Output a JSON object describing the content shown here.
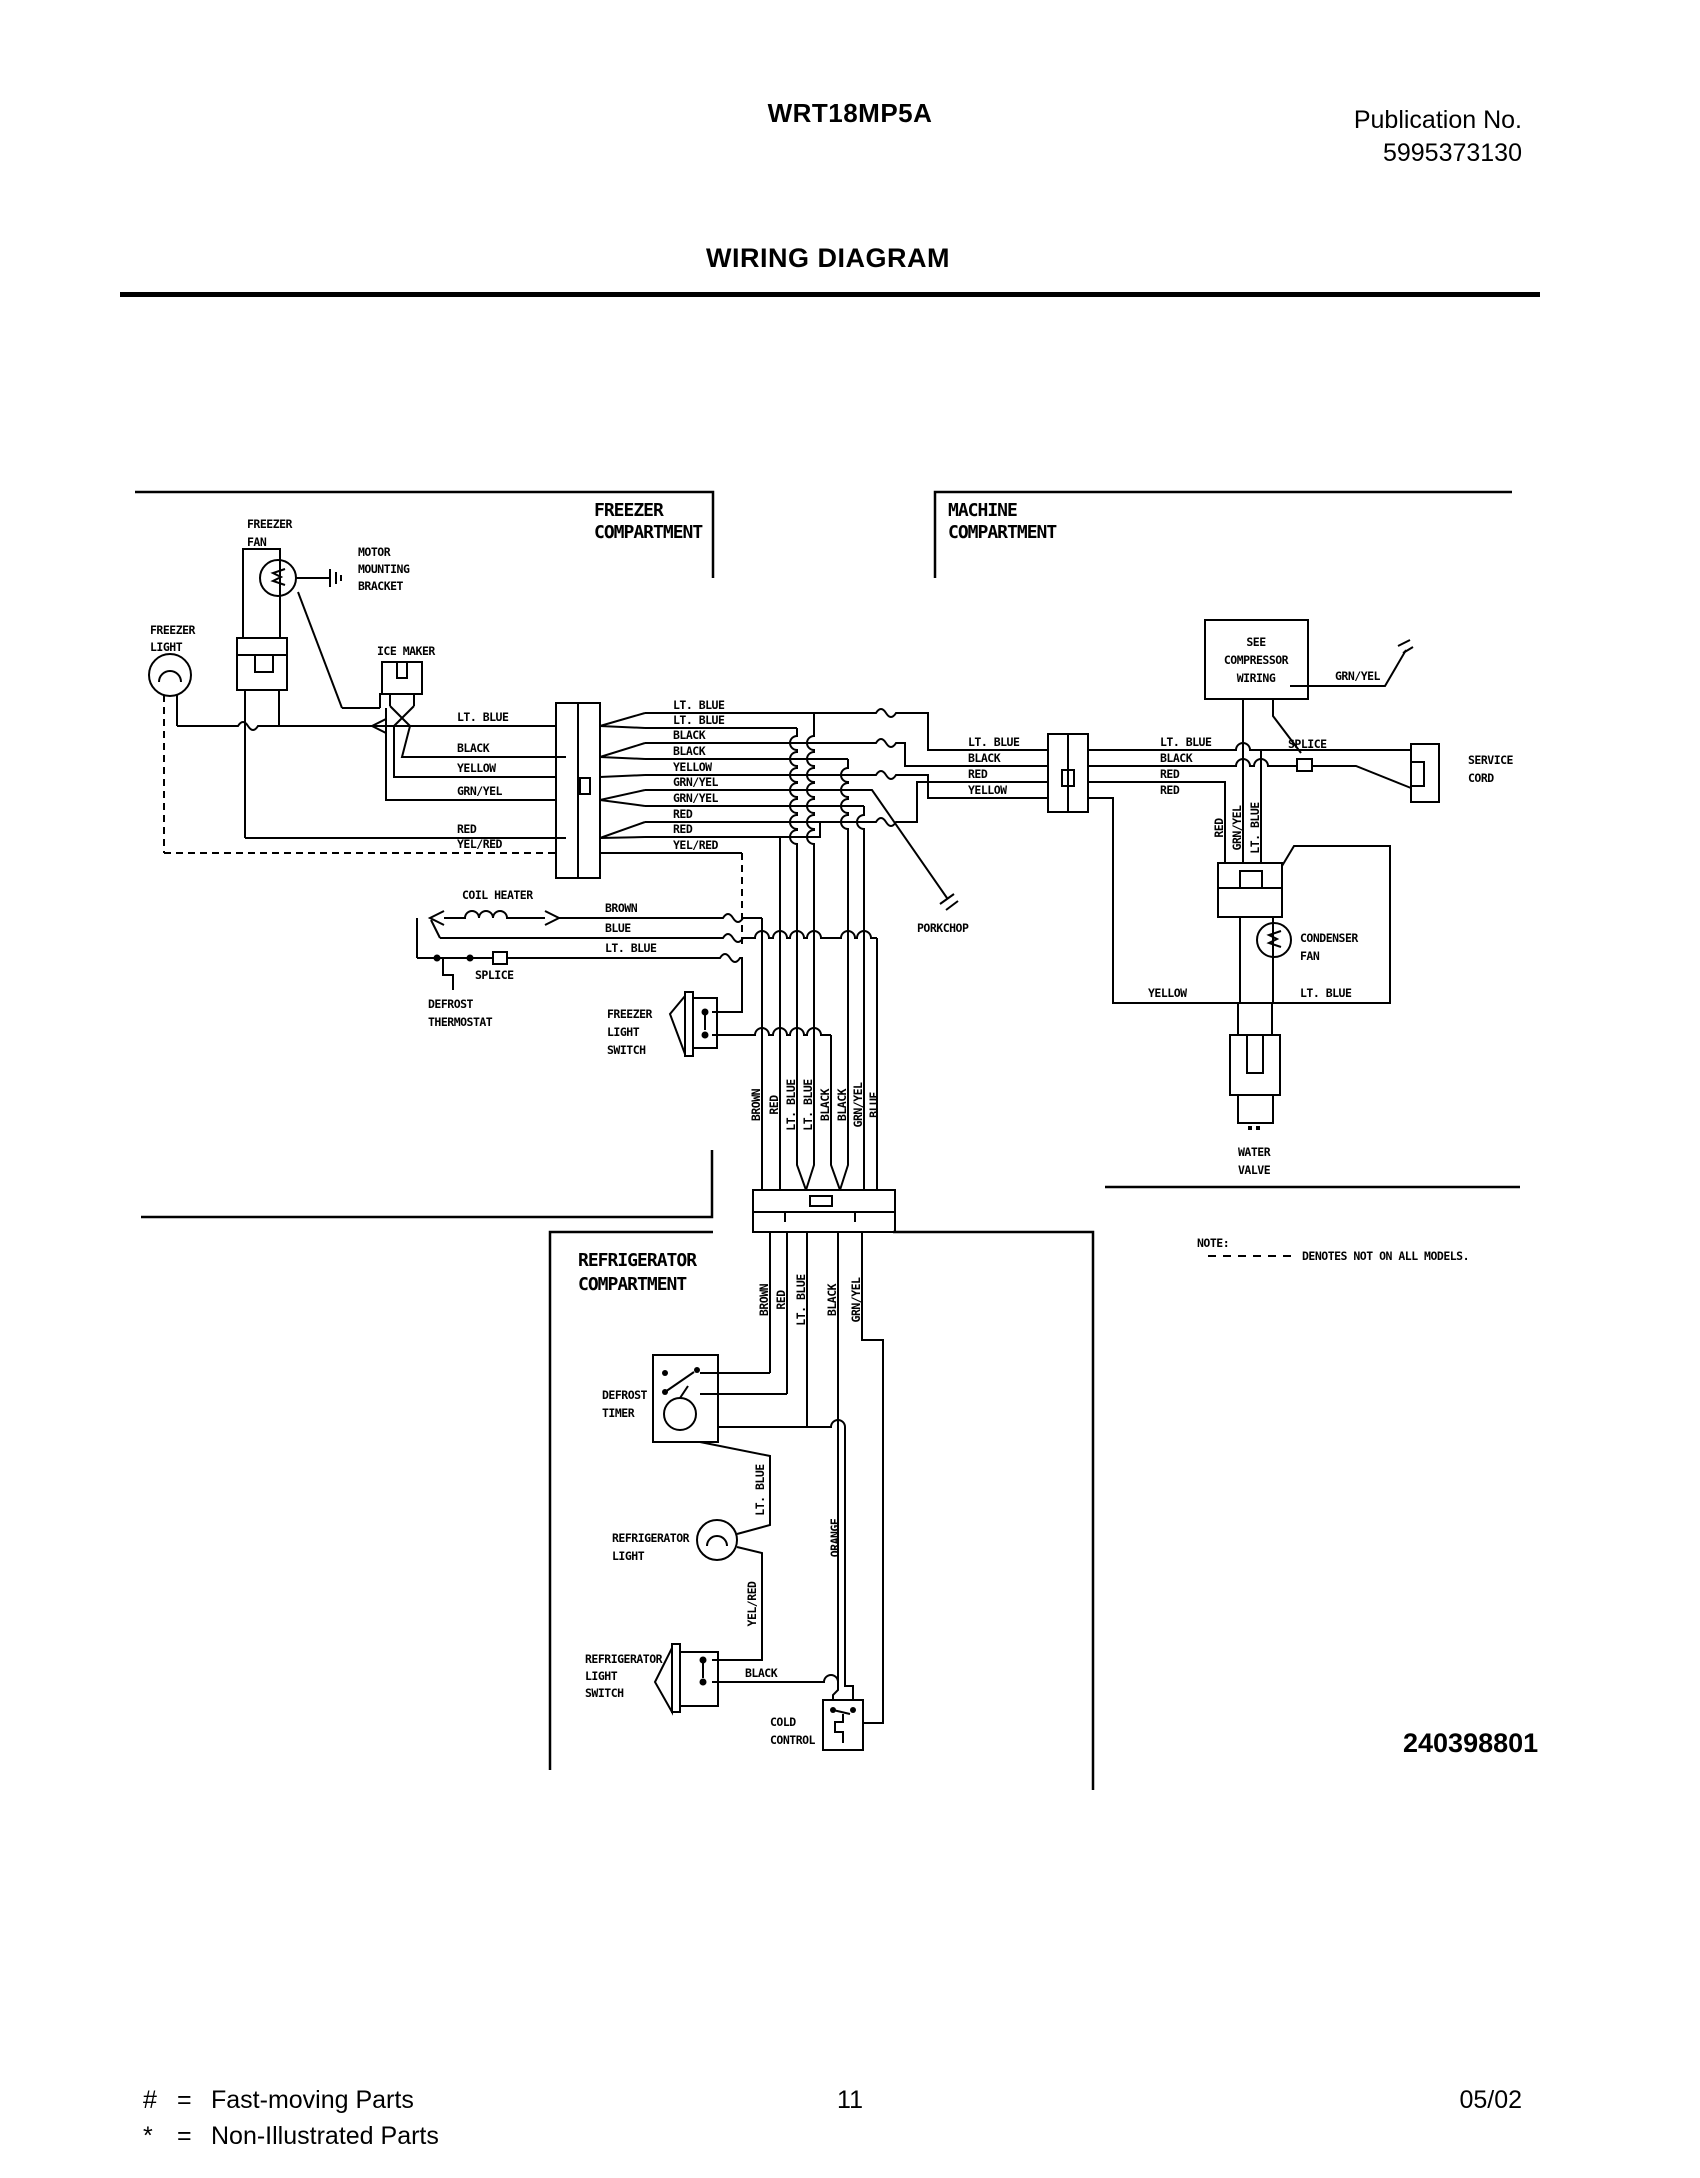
{
  "header": {
    "model": "WRT18MP5A",
    "publication_label": "Publication No.",
    "publication_number": "5995373130",
    "title": "WIRING DIAGRAM"
  },
  "footer": {
    "legend": [
      {
        "symbol": "#",
        "eq": "=",
        "label": "Fast-moving Parts"
      },
      {
        "symbol": "*",
        "eq": "=",
        "label": "Non-Illustrated Parts"
      }
    ],
    "page_number": "11",
    "date": "05/02"
  },
  "part_number": "240398801",
  "note": {
    "label": "NOTE:",
    "text": "DENOTES NOT ON ALL MODELS."
  },
  "compartments": {
    "freezer": [
      "FREEZER",
      "COMPARTMENT"
    ],
    "machine": [
      "MACHINE",
      "COMPARTMENT"
    ],
    "refrigerator": [
      "REFRIGERATOR",
      "COMPARTMENT"
    ]
  },
  "components": {
    "freezer_fan": [
      "FREEZER",
      "FAN"
    ],
    "motor_mounting_bracket": [
      "MOTOR",
      "MOUNTING",
      "BRACKET"
    ],
    "freezer_light": [
      "FREEZER",
      "LIGHT"
    ],
    "ice_maker": "ICE MAKER",
    "coil_heater": "COIL HEATER",
    "defrost_thermostat": [
      "DEFROST",
      "THERMOSTAT"
    ],
    "splice": "SPLICE",
    "freezer_light_switch": [
      "FREEZER",
      "LIGHT",
      "SWITCH"
    ],
    "porkchop": "PORKCHOP",
    "compressor": [
      "SEE",
      "COMPRESSOR",
      "WIRING"
    ],
    "service_cord": [
      "SERVICE",
      "CORD"
    ],
    "condenser_fan": [
      "CONDENSER",
      "FAN"
    ],
    "water_valve": [
      "WATER",
      "VALVE"
    ],
    "defrost_timer": [
      "DEFROST",
      "TIMER"
    ],
    "refrigerator_light": [
      "REFRIGERATOR",
      "LIGHT"
    ],
    "refrigerator_light_switch": [
      "REFRIGERATOR",
      "LIGHT",
      "SWITCH"
    ],
    "cold_control": [
      "COLD",
      "CONTROL"
    ]
  },
  "wires": {
    "freezer_left": [
      "LT. BLUE",
      "BLACK",
      "YELLOW",
      "GRN/YEL",
      "RED",
      "YEL/RED"
    ],
    "freezer_right": [
      "LT. BLUE",
      "LT. BLUE",
      "BLACK",
      "BLACK",
      "YELLOW",
      "GRN/YEL",
      "GRN/YEL",
      "RED",
      "RED",
      "YEL/RED"
    ],
    "machine_left": [
      "LT. BLUE",
      "BLACK",
      "RED",
      "YELLOW"
    ],
    "machine_right": [
      "LT. BLUE",
      "BLACK",
      "RED",
      "RED"
    ],
    "heater_rows": [
      "BROWN",
      "BLUE",
      "LT. BLUE"
    ],
    "bundle_top": [
      "BROWN",
      "RED",
      "LT. BLUE",
      "LT. BLUE",
      "BLACK",
      "BLACK",
      "GRN/YEL",
      "BLUE"
    ],
    "bundle_bottom": [
      "BROWN",
      "RED",
      "LT. BLUE",
      "BLACK",
      "GRN/YEL"
    ],
    "relay_wires": [
      "RED",
      "GRN/YEL",
      "LT. BLUE"
    ],
    "compressor_ground": "GRN/YEL",
    "condenser_yellow": "YELLOW",
    "condenser_lt_blue": "LT. BLUE",
    "fridge_lt_blue": "LT. BLUE",
    "fridge_orange": "ORANGE",
    "fridge_yel_red": "YEL/RED",
    "fridge_black": "BLACK"
  }
}
